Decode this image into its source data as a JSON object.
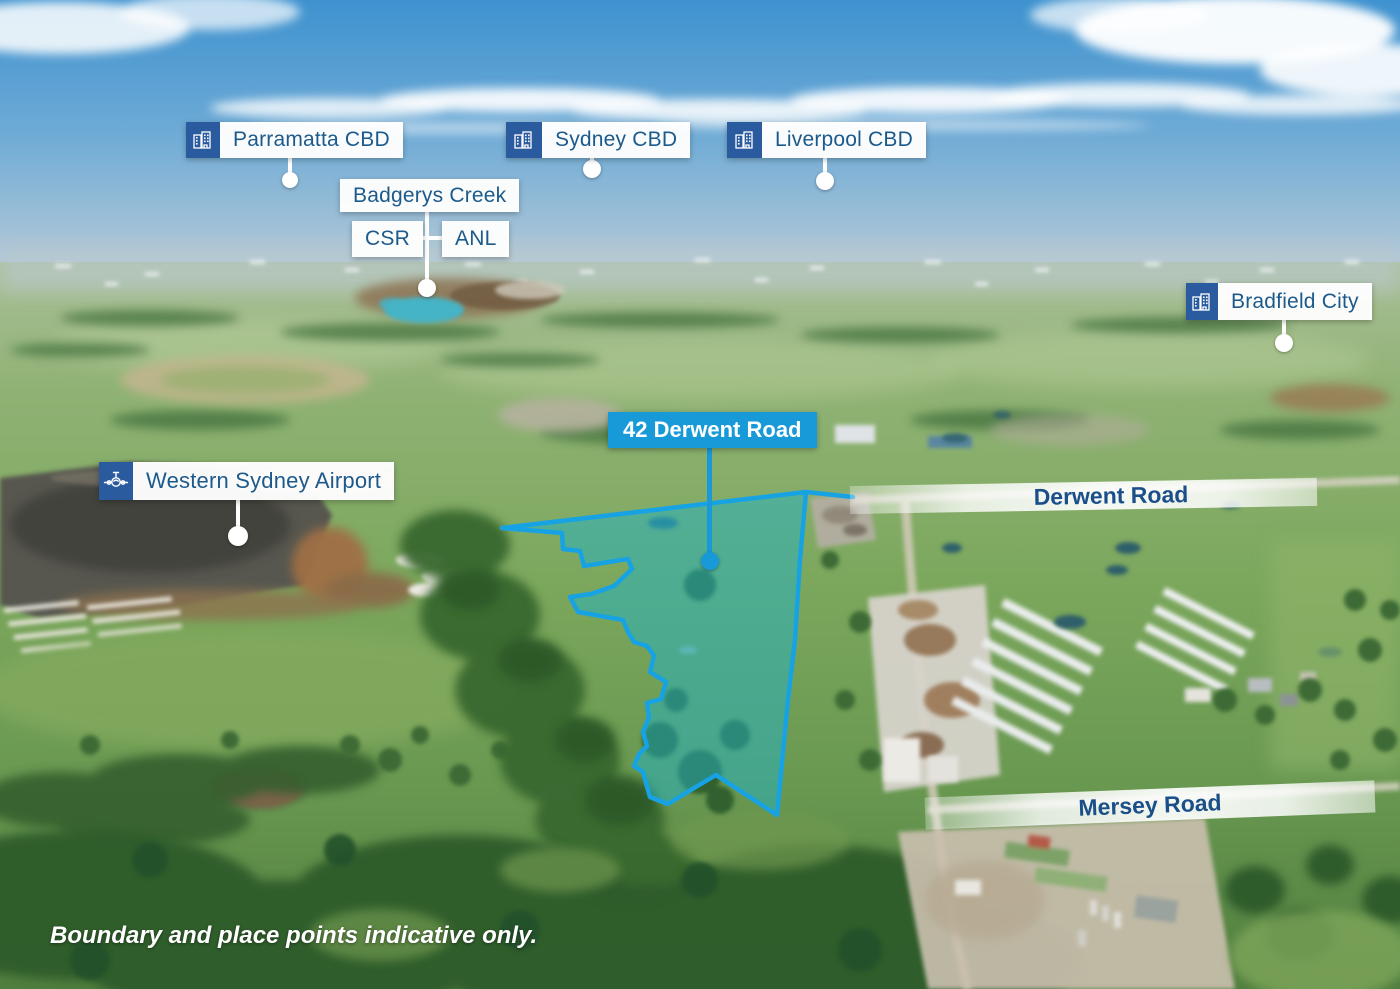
{
  "map": {
    "disclaimer": "Boundary and place points indicative only.",
    "property": {
      "label": "42 Derwent Road"
    },
    "roads": {
      "derwent": "Derwent Road",
      "mersey": "Mersey Road"
    },
    "places": {
      "parramatta": {
        "label": "Parramatta CBD",
        "icon": "city-buildings-icon"
      },
      "sydney": {
        "label": "Sydney CBD",
        "icon": "city-buildings-icon"
      },
      "liverpool": {
        "label": "Liverpool CBD",
        "icon": "city-buildings-icon"
      },
      "badgerys_creek": {
        "label": "Badgerys Creek"
      },
      "csr": {
        "label": "CSR"
      },
      "anl": {
        "label": "ANL"
      },
      "bradfield": {
        "label": "Bradfield City",
        "icon": "city-buildings-icon"
      },
      "airport": {
        "label": "Western Sydney Airport",
        "icon": "airplane-icon"
      }
    },
    "colors": {
      "label_text_blue": "#1c5a8c",
      "icon_background_blue": "#2a5b9e",
      "property_label_blue": "#189ad8",
      "boundary_stroke": "#17a3e3",
      "boundary_fill": "rgba(34,178,196,0.5)",
      "road_banner_text": "#1b4f8a"
    }
  }
}
